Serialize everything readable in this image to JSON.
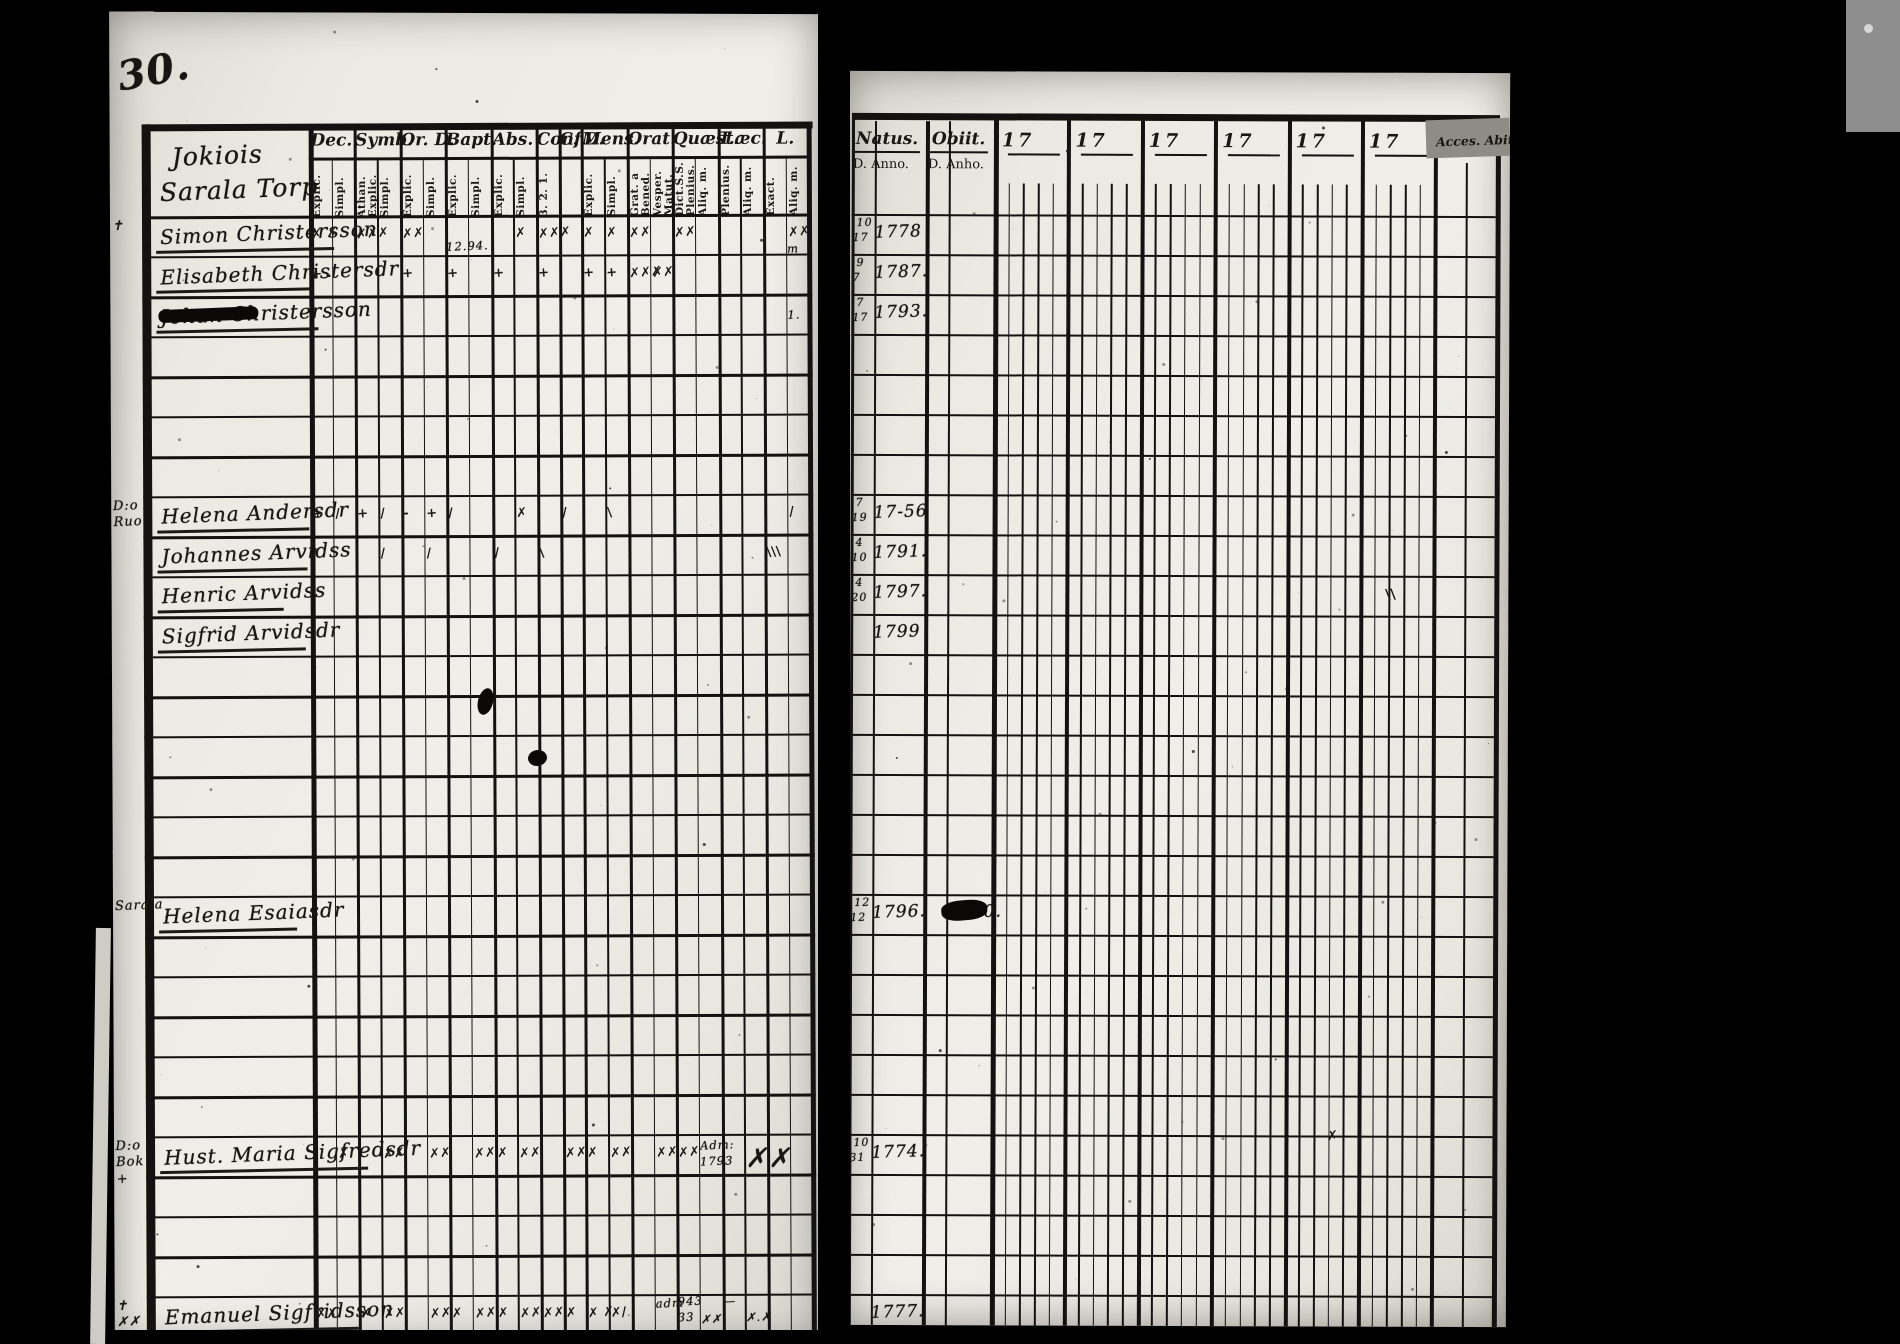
{
  "page_number": "30.",
  "left_page": {
    "title_line1": "Jokiois",
    "title_line2": "Sarala Torp",
    "column_groups": [
      {
        "label": "Dec.",
        "subs": [
          "Explic.",
          "Simpl."
        ]
      },
      {
        "label": "Symb.",
        "subs": [
          "Athan. Explic.",
          "Simpl."
        ]
      },
      {
        "label": "Or. D.",
        "subs": [
          "Explic.",
          "Simpl."
        ]
      },
      {
        "label": "Bapt.",
        "subs": [
          "Explic.",
          "Simpl."
        ]
      },
      {
        "label": "Abs.",
        "subs": [
          "Explic.",
          "Simpl."
        ]
      },
      {
        "label": "Conf.",
        "subs": [
          "3. 2. 1."
        ]
      },
      {
        "label": "C. D.",
        "subs": [
          ""
        ]
      },
      {
        "label": "Mens.",
        "subs": [
          "Explic.",
          "Simpl."
        ]
      },
      {
        "label": "Orat.",
        "subs": [
          "Grat. a Bened.",
          "Vesper. Matut."
        ]
      },
      {
        "label": "Quæst.",
        "subs": [
          "Dict.S.S. Plenius.",
          "Aliq. m."
        ]
      },
      {
        "label": "T.æc.",
        "subs": [
          "Plenius.",
          "Aliq. m."
        ]
      },
      {
        "label": "L.",
        "subs": [
          "Exact.",
          "Aliq. m."
        ]
      }
    ]
  },
  "right_page": {
    "natus_label": "Natus.",
    "obiit_label": "Obiit.",
    "natus_sub": "D. Anno.",
    "obiit_sub": "D. Anho.",
    "year_prefix": "17",
    "year_column_count": 6,
    "year_subcolumns": 5,
    "acces_label": "Acces. Abit."
  },
  "persons": [
    {
      "row": 0,
      "margin": "✝",
      "name": "Simon Christersson",
      "underline": 178,
      "natus_d_top": "10",
      "natus_d_bot": "17",
      "natus_anno": "1778",
      "marks": [
        {
          "c": 0,
          "t": "✗ ✗"
        },
        {
          "c": 2,
          "t": "✗✗✗"
        },
        {
          "c": 4,
          "t": "✗✗"
        },
        {
          "c": 9,
          "t": "✗"
        },
        {
          "c": 10,
          "t": "✗✗✗"
        },
        {
          "c": 12,
          "t": "✗"
        },
        {
          "c": 13,
          "t": "✗"
        },
        {
          "c": 14,
          "t": "✗✗"
        },
        {
          "c": 16,
          "t": "✗✗"
        },
        {
          "c": 21,
          "t": "✗✗"
        }
      ],
      "notes": [
        {
          "c": 6,
          "t": "12.94.",
          "dy": 14
        },
        {
          "c": 21,
          "t": "m",
          "dy": 18
        }
      ]
    },
    {
      "row": 1,
      "name": "Elisabeth Christersdr",
      "underline": 155,
      "natus_d_top": "9",
      "natus_d_bot": "7",
      "natus_anno": "1787.",
      "marks": [
        {
          "c": 0,
          "t": "+ ."
        },
        {
          "c": 4,
          "t": "+"
        },
        {
          "c": 6,
          "t": "+"
        },
        {
          "c": 8,
          "t": "+"
        },
        {
          "c": 10,
          "t": "+"
        },
        {
          "c": 12,
          "t": "+"
        },
        {
          "c": 13,
          "t": "+"
        },
        {
          "c": 14,
          "t": "✗✗✗"
        },
        {
          "c": 15,
          "t": "✗✗"
        }
      ],
      "notes": []
    },
    {
      "row": 2,
      "name": "Johan Christersson",
      "underline": 162,
      "strike": true,
      "natus_d_top": "7",
      "natus_d_bot": "17",
      "natus_anno": "1793.",
      "marks": [],
      "notes": [
        {
          "c": 21,
          "t": "1.",
          "dy": 4
        }
      ]
    },
    {
      "row": 7,
      "margin": "D:o Ruo",
      "name": "Helena Andersdr",
      "underline": 152,
      "natus_d_top": "7",
      "natus_d_bot": "19",
      "natus_anno": "17-56",
      "marks": [
        {
          "c": 0,
          "t": "+"
        },
        {
          "c": 1,
          "t": "/"
        },
        {
          "c": 2,
          "t": "+"
        },
        {
          "c": 3,
          "t": "/"
        },
        {
          "c": 4,
          "t": "-"
        },
        {
          "c": 5,
          "t": "+"
        },
        {
          "c": 6,
          "t": "/"
        },
        {
          "c": 9,
          "t": "✗"
        },
        {
          "c": 11,
          "t": "/"
        },
        {
          "c": 13,
          "t": "\\"
        },
        {
          "c": 21,
          "t": "/"
        }
      ],
      "notes": []
    },
    {
      "row": 8,
      "name": "Johannes Arvidss",
      "underline": 150,
      "natus_d_top": "4",
      "natus_d_bot": "10",
      "natus_anno": "1791.",
      "marks": [
        {
          "c": 0,
          "t": "/"
        },
        {
          "c": 3,
          "t": "/"
        },
        {
          "c": 5,
          "t": "/"
        },
        {
          "c": 8,
          "t": "/"
        },
        {
          "c": 10,
          "t": "\\"
        },
        {
          "c": 20,
          "t": "\\\\\\"
        }
      ],
      "notes": []
    },
    {
      "row": 9,
      "name": "Henric Arvidss",
      "underline": 126,
      "natus_d_top": "4",
      "natus_d_bot": "20",
      "natus_anno": "1797.",
      "marks": [],
      "notes": []
    },
    {
      "row": 10,
      "name": "Sigfrid Arvidsdr",
      "underline": 148,
      "natus_anno": "1799",
      "marks": [],
      "notes": []
    },
    {
      "row": 17,
      "margin": "Sarala",
      "name": "Helena Esaiasdr",
      "underline": 138,
      "natus_d_top": "12",
      "natus_d_bot": "12",
      "natus_anno": "1796.",
      "obiit_anno": "1800.",
      "obiit_blot": true,
      "marks": [],
      "notes": []
    },
    {
      "row": 23,
      "margin": "D:o Bok +",
      "name": "Hust. Maria Sigfredsdr",
      "underline": 208,
      "natus_d_top": "10",
      "natus_d_bot": "31",
      "natus_anno": "1774.",
      "marks": [
        {
          "c": 1,
          "t": "✗"
        },
        {
          "c": 3,
          "t": "✗✗"
        },
        {
          "c": 5,
          "t": "✗✗"
        },
        {
          "c": 7,
          "t": "✗✗"
        },
        {
          "c": 8,
          "t": "✗"
        },
        {
          "c": 9,
          "t": "✗✗"
        },
        {
          "c": 11,
          "t": "✗✗"
        },
        {
          "c": 12,
          "t": "✗"
        },
        {
          "c": 13,
          "t": "✗✗"
        },
        {
          "c": 15,
          "t": "✗✗"
        },
        {
          "c": 16,
          "t": "✗✗"
        }
      ],
      "notes": [
        {
          "c": 17,
          "t": "Adm:",
          "dy": -6
        },
        {
          "c": 17,
          "t": "1793",
          "dy": 10
        },
        {
          "c": 19,
          "t": "✗",
          "big": true,
          "dy": 0
        },
        {
          "c": 20,
          "t": "✗",
          "big": true,
          "dy": 0
        }
      ]
    },
    {
      "row": 27,
      "margin": "✝ ✗✗",
      "name": "Emanuel Sigfridsson",
      "underline": 198,
      "natus_anno": "1777.",
      "marks": [
        {
          "c": 0,
          "t": "✗✗"
        },
        {
          "c": 2,
          "t": "✗"
        },
        {
          "c": 3,
          "t": "✗✗"
        },
        {
          "c": 5,
          "t": "✗✗"
        },
        {
          "c": 6,
          "t": "✗"
        },
        {
          "c": 7,
          "t": "✗✗"
        },
        {
          "c": 8,
          "t": "✗"
        },
        {
          "c": 9,
          "t": "✗✗"
        },
        {
          "c": 10,
          "t": "✗✗"
        },
        {
          "c": 11,
          "t": "✗"
        },
        {
          "c": 12,
          "t": "✗ ✗"
        },
        {
          "c": 13,
          "t": "✗/"
        }
      ],
      "notes": [
        {
          "c": 15,
          "t": "adm",
          "dy": -8
        },
        {
          "c": 16,
          "t": "943",
          "dy": -10
        },
        {
          "c": 16,
          "t": "33",
          "dy": 6
        },
        {
          "c": 17,
          "t": "✗✗",
          "dy": 8
        },
        {
          "c": 18,
          "t": "—",
          "dy": -10
        },
        {
          "c": 19,
          "t": "✗.✗",
          "dy": 6
        }
      ]
    }
  ],
  "right_extras": [
    {
      "x": 1385,
      "y": 586,
      "t": "\\\\"
    },
    {
      "x": 1328,
      "y": 1128,
      "t": "✗"
    }
  ]
}
